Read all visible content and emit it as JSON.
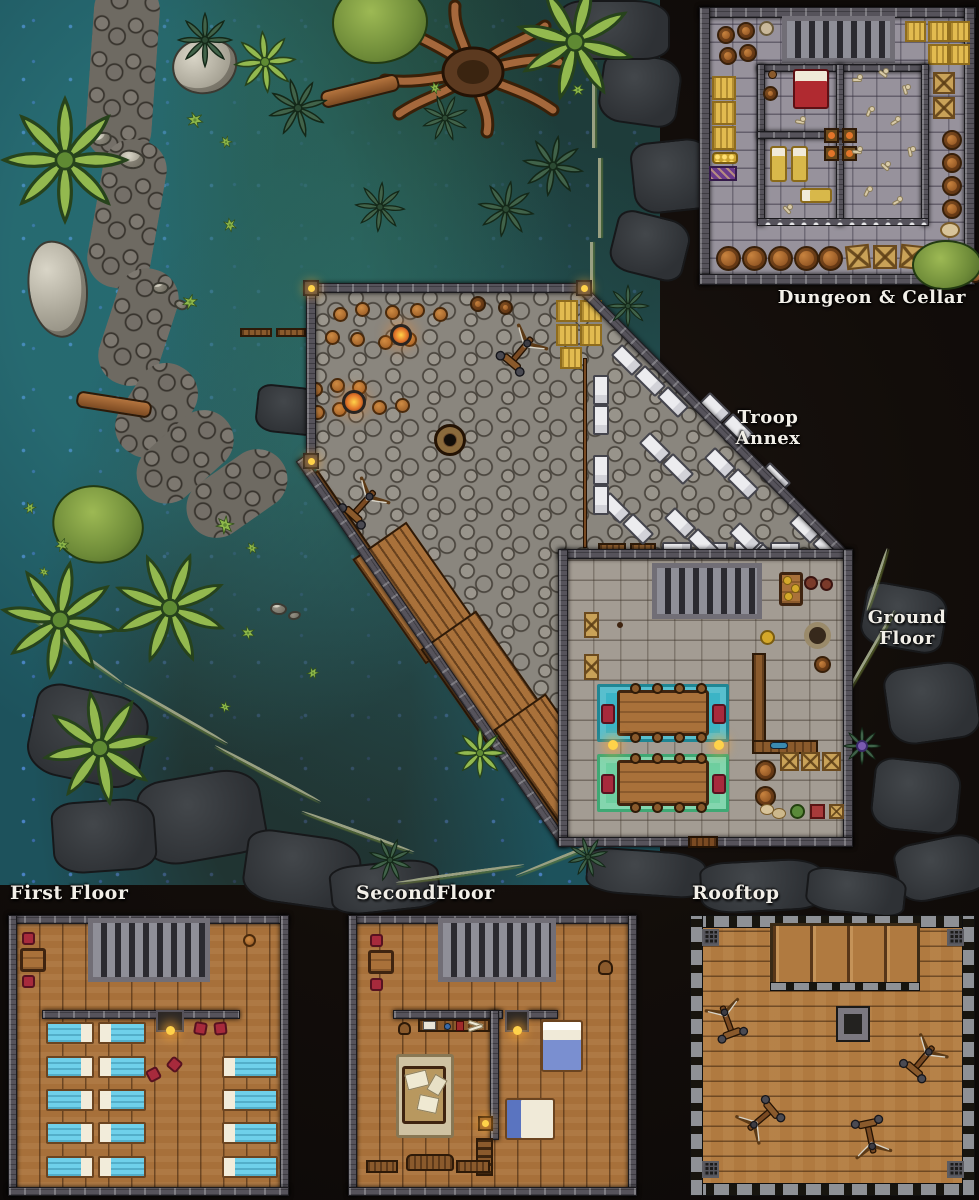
{
  "map_title": "Jungle outpost battle map with fort, troop annex and multi-floor insets",
  "labels": {
    "dungeon_cellar": "Dungeon & Cellar",
    "troop_line1": "Troop",
    "troop_line2": "Annex",
    "ground_line1": "Ground",
    "ground_line2": "Floor",
    "first_floor": "First Floor",
    "second_floor": "SecondFloor",
    "rooftop": "Rooftop"
  },
  "palette": {
    "background_rock": "#120d0a",
    "swamp_water": "#1d525c",
    "blue_flower_speckle": "#4a82c4",
    "jungle_leaf_light": "#93b94f",
    "jungle_leaf_dark": "#41634a",
    "cobblestone": "#8a867e",
    "stone_wall": "#56535b",
    "wood_floor": "#a7703a",
    "dungeon_floor": "#97929c",
    "bed_blanket_blue": "#6fd0ea",
    "cot_white": "#ececef",
    "chair_red": "#a72a3c",
    "rug_teal": "#3bb4c6",
    "rug_green": "#6ecfa0",
    "hay_yellow": "#e2bb50",
    "barrel_brown": "#a85f28",
    "label_text": "#f2efe8"
  },
  "areas": {
    "jungle": {
      "palm_trees": 7,
      "dark_plants": 9,
      "bushes": 12,
      "canopy_trees": 3,
      "rocks": 8,
      "fallen_logs": 3,
      "stone_path": 1
    },
    "courtyard": {
      "round_stools": 16,
      "campfires": 2,
      "ballistas": 2,
      "hay_bales": 5,
      "central_well": 1,
      "dock_rafts": 3,
      "benches": 4
    },
    "troop_annex": {
      "white_cots": 32
    },
    "ground_floor": {
      "long_tables": 2,
      "rugs": [
        "teal",
        "green"
      ],
      "red_armchairs": 4,
      "stair_grate": 1,
      "wall_torches": 2,
      "barrels": 2,
      "crates": 3,
      "round_basin": 1
    },
    "dungeon_cellar": {
      "barrels": 13,
      "hay_bales": 8,
      "crates": 5,
      "red_bed": 1,
      "yellow_bedrolls": 3,
      "braziers": 4,
      "bone_piles": 10,
      "stair_grate": 1,
      "cells": 3
    },
    "first_floor": {
      "blue_beds": 14,
      "red_chairs": 6,
      "stair_grate": 1,
      "fireplace": 1,
      "table": 1,
      "stool": 1
    },
    "second_floor": {
      "double_beds": 2,
      "desks": 2,
      "map_rug": 1,
      "couch": 1,
      "benches": 2,
      "ladder": 1,
      "stair_grate": 1,
      "fireplace": 1,
      "red_chairs": 2
    },
    "rooftop": {
      "ballistas": 4,
      "chimney": 1,
      "sloped_roof_panel": 1,
      "corner_hatches": 4
    }
  }
}
